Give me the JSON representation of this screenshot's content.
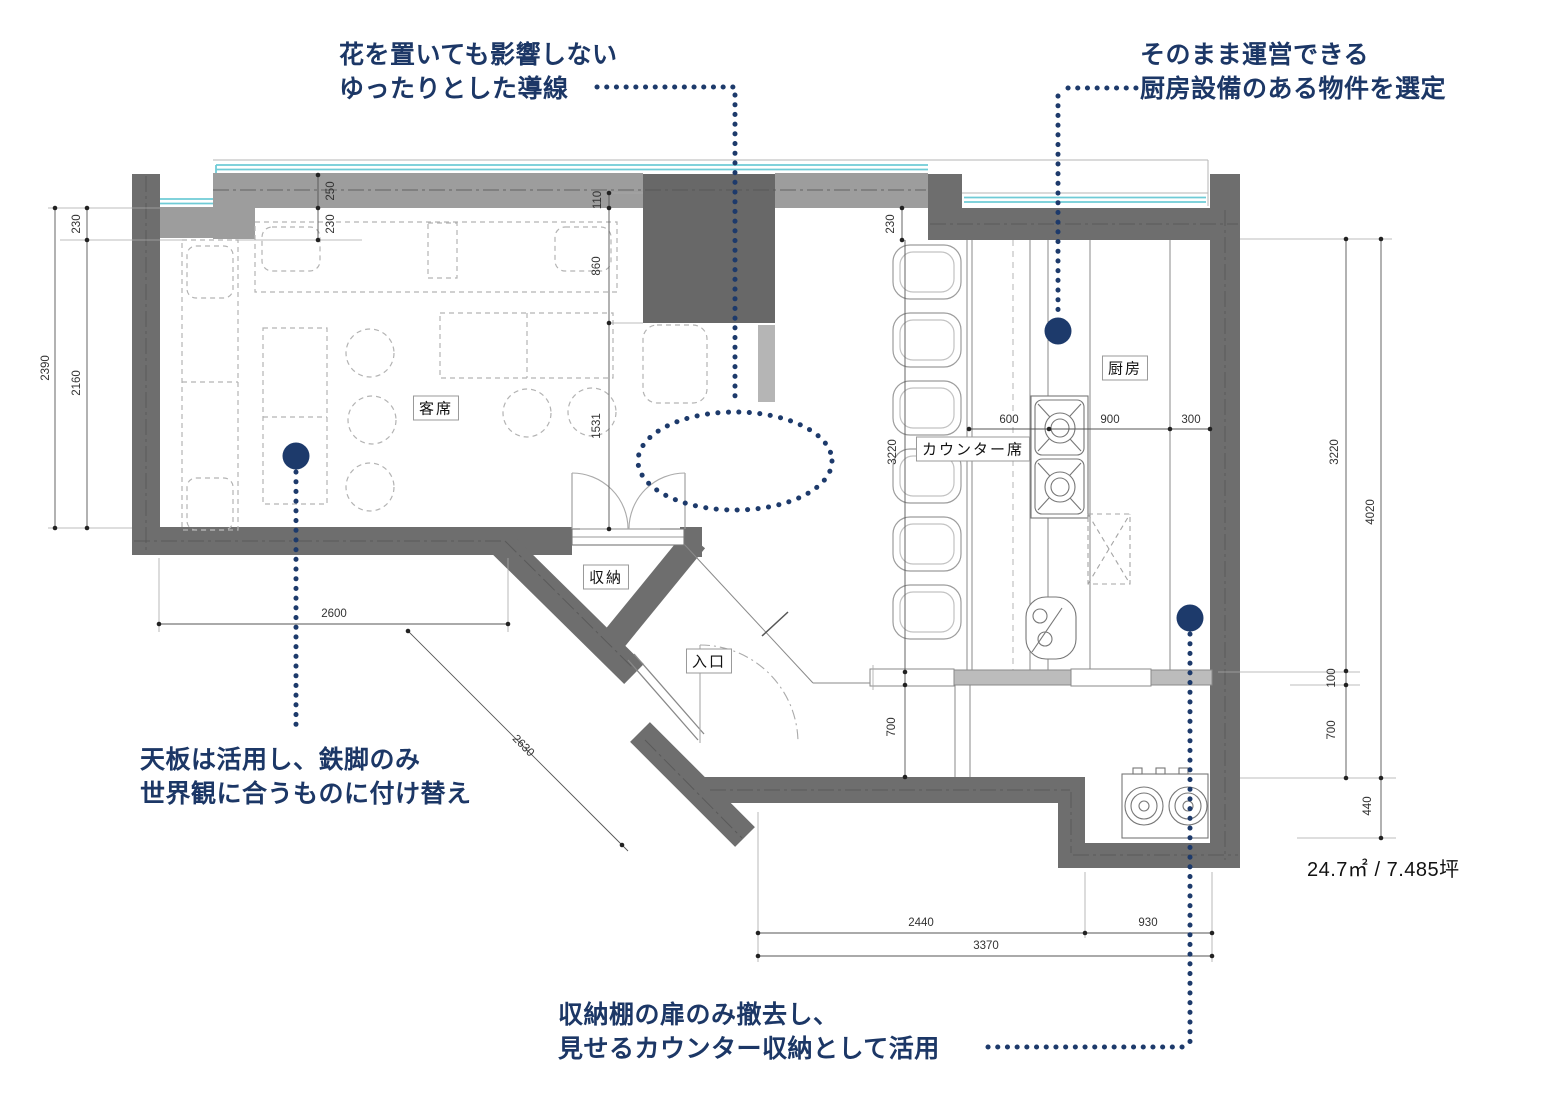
{
  "annotations": {
    "flow_line": {
      "text1": "花を置いても影響しない",
      "text2": "ゆったりとした導線"
    },
    "kitchen_equipment": {
      "text1": "そのまま運営できる",
      "text2": "厨房設備のある物件を選定"
    },
    "table_legs": {
      "text1": "天板は活用し、鉄脚のみ",
      "text2": "世界観に合うものに付け替え"
    },
    "storage_counter": {
      "text1": "収納棚の扉のみ撤去し、",
      "text2": "見せるカウンター収納として活用"
    }
  },
  "room_labels": {
    "guest_seating": "客席",
    "counter_seating": "カウンター席",
    "kitchen": "厨房",
    "storage": "収納",
    "entrance": "入口"
  },
  "area_label": "24.7㎡ / 7.485坪",
  "dimensions": {
    "left_total": "2390",
    "left_wall": "230",
    "left_inner": "2160",
    "top_wall": "250",
    "top_bench": "230",
    "center_top": "110",
    "center_block": "860",
    "center_opening": "1531",
    "counter_wall": "230",
    "counter_left": "3220",
    "counter_left_lower": "700",
    "kitchen_600": "600",
    "kitchen_900": "900",
    "kitchen_300": "300",
    "right_inner": "3220",
    "right_total": "4020",
    "right_100": "100",
    "right_700": "700",
    "right_440": "440",
    "bottom_left": "2600",
    "entrance_diag": "2630",
    "bottom_2440": "2440",
    "bottom_930": "930",
    "bottom_total": "3370"
  },
  "colors": {
    "accent_navy": "#1c3766",
    "wall_dark": "#6e6e6e",
    "wall_light": "#9d9d9d",
    "window_cyan": "#6fcbd6"
  }
}
